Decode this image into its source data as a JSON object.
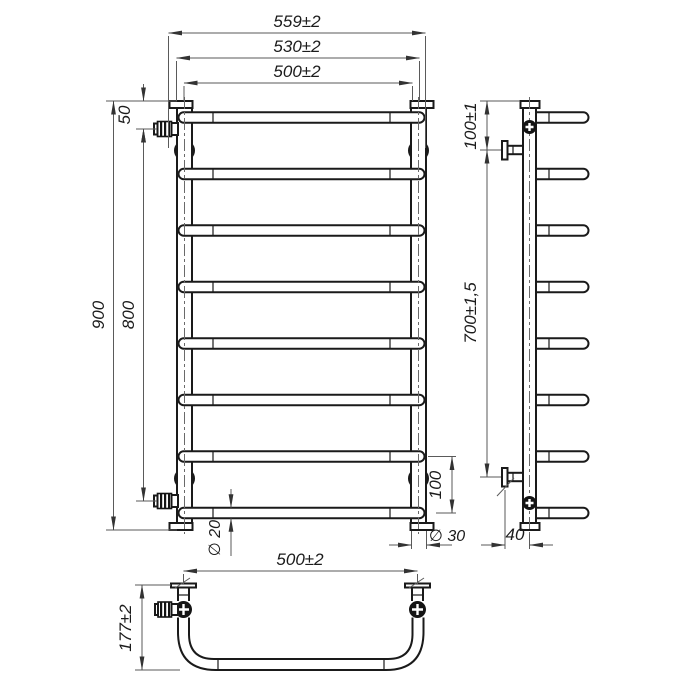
{
  "drawing": {
    "front": {
      "width_outer": "559±2",
      "width_centers": "530±2",
      "width_inner": "500±2",
      "height_total": "900",
      "height_connections": "800",
      "top_offset": "50",
      "bottom_bar_gap": "100",
      "bar_diameter": "∅ 20",
      "tube_diameter": "∅ 30"
    },
    "side": {
      "top_bracket_offset": "100±1",
      "bracket_span": "700±1,5",
      "wall_distance": "40"
    },
    "bottom": {
      "width_centers": "500±2",
      "depth": "177±2"
    },
    "colors": {
      "line": "#1a1a1a",
      "dimension": "#5a5a5a",
      "background": "#ffffff"
    }
  }
}
